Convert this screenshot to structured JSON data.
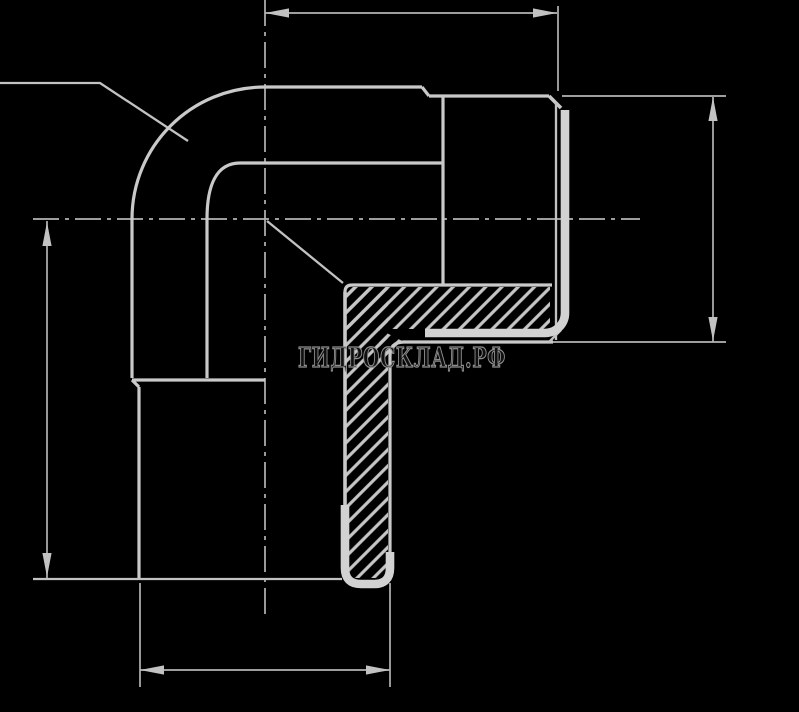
{
  "page": {
    "background": "#000000",
    "width": 799,
    "height": 712,
    "description_visible_content": "technical line drawing of a 90-degree elbow pipe fitting, half-section with hatching, four unlabelled dimension lines, dash-dot centerlines and a watermark"
  },
  "drawing": {
    "watermark": {
      "text": "ГИДРОСКЛАД.РФ",
      "x": 298,
      "y": 367,
      "font_size": 27,
      "text_length": 208,
      "fill": "#101010",
      "stroke": "#8e8e8e",
      "stroke_width": 1.25
    },
    "styles": {
      "center": {
        "w": 1.7,
        "color": "#b4b4b4",
        "dash": "26 6 4 6"
      },
      "thin": {
        "w": 1.7,
        "color": "#b4b4b4",
        "dash": ""
      },
      "med": {
        "w": 2.3,
        "color": "#c2c2c2",
        "dash": ""
      },
      "main": {
        "w": 3.2,
        "color": "#c9c9c9",
        "dash": ""
      },
      "bold": {
        "w": 3.6,
        "color": "#c9c9c9",
        "dash": ""
      },
      "thick": {
        "w": 8.6,
        "color": "#d2d2d2",
        "dash": ""
      }
    },
    "hatch": {
      "spacing": 11.5,
      "line_width": 3.2,
      "angle": -45,
      "color": "#c6c6c6"
    },
    "hatch_regions": [
      {
        "name": "hatch-horizontal-wall",
        "d": "M346,287 H550 V329 H346 Z"
      },
      {
        "name": "hatch-vertical-wall",
        "d": "M346,287 H388 V578 H346 Z"
      },
      {
        "name": "hatch-fillet-corner",
        "d": "M379,329 L404,342 L390,356 L379,350 Z"
      }
    ],
    "shapes": [
      {
        "name": "centerline-vertical",
        "kind": "center",
        "d": "M265,0 V614"
      },
      {
        "name": "centerline-horizontal",
        "kind": "center",
        "d": "M33,219 H640"
      },
      {
        "name": "dim-line-top",
        "kind": "thin",
        "d": "M265,13 H557"
      },
      {
        "name": "dim-line-right",
        "kind": "thin",
        "d": "M713,97 V342"
      },
      {
        "name": "dim-line-left",
        "kind": "thin",
        "d": "M47,221 V578"
      },
      {
        "name": "dim-line-bottom",
        "kind": "thin",
        "d": "M140,670 H390"
      },
      {
        "name": "extension-top-right",
        "kind": "thin",
        "d": "M558,6 V91"
      },
      {
        "name": "extension-right-upper",
        "kind": "thin",
        "d": "M562,96 H726"
      },
      {
        "name": "extension-right-lower",
        "kind": "thin",
        "d": "M548,342 H726"
      },
      {
        "name": "extension-bottom-left",
        "kind": "thin",
        "d": "M140,583 V687"
      },
      {
        "name": "extension-bottom-right",
        "kind": "thin",
        "d": "M390,583 V687"
      },
      {
        "name": "leader-upper-left",
        "kind": "med",
        "d": "M0,83 H100 L188,141"
      },
      {
        "name": "leader-inner-corner",
        "kind": "med",
        "d": "M267,221 L343,283"
      },
      {
        "name": "outer-bend-arc",
        "kind": "main",
        "d": "M132,219 C132,146 191,87 265,87"
      },
      {
        "name": "outer-top-line",
        "kind": "main",
        "d": "M265,87 H422"
      },
      {
        "name": "step-top",
        "kind": "main",
        "d": "M422,87 L429,96"
      },
      {
        "name": "nipple-top-line",
        "kind": "main",
        "d": "M429,96 H549"
      },
      {
        "name": "chamfer-top-right",
        "kind": "bold",
        "d": "M549,96 L561,108"
      },
      {
        "name": "inner-bend-arc",
        "kind": "main",
        "d": "M207,219 C207,186 216,163 240,163"
      },
      {
        "name": "inner-top-line",
        "kind": "main",
        "d": "M240,163 H443"
      },
      {
        "name": "collar-face-line",
        "kind": "main",
        "d": "M443,96 V284"
      },
      {
        "name": "tube-outer-left",
        "kind": "main",
        "d": "M132,219 V378"
      },
      {
        "name": "tube-inner-right",
        "kind": "main",
        "d": "M207,219 V378"
      },
      {
        "name": "socket-top-face",
        "kind": "main",
        "d": "M132,380 H265"
      },
      {
        "name": "step-left",
        "kind": "main",
        "d": "M132,380 L139,387"
      },
      {
        "name": "socket-outer-left",
        "kind": "main",
        "d": "M139,387 V579"
      },
      {
        "name": "bore-horizontal",
        "kind": "main",
        "d": "M352,285 H552"
      },
      {
        "name": "bore-corner-fillet",
        "kind": "main",
        "d": "M345,292 Q345,285 352,285"
      },
      {
        "name": "bore-vertical",
        "kind": "bold",
        "d": "M345,292 V560"
      },
      {
        "name": "outer-bottom-line",
        "kind": "main",
        "d": "M404,342 H553"
      },
      {
        "name": "inner-corner-fillet",
        "kind": "main",
        "d": "M404,342 Q390,342 390,356"
      },
      {
        "name": "socket-outer-right",
        "kind": "main",
        "d": "M390,356 V572"
      },
      {
        "name": "end-face-right-thin",
        "kind": "med",
        "d": "M556,102 V340"
      },
      {
        "name": "chamfer-bottom-right",
        "kind": "med",
        "d": "M549,342 L561,330"
      },
      {
        "name": "end-face-bottom-line",
        "kind": "med",
        "d": "M33,579 H342"
      },
      {
        "name": "thread-root-thick-bar",
        "kind": "thick",
        "d": "M425,333 H545 A20,20 0 0 0 565,313 V110"
      },
      {
        "name": "bottom-end-thick-u",
        "kind": "thick",
        "d": "M345,505 V568 Q345,584 361,584 H374 Q390,584 390,568 V552"
      }
    ],
    "arrows": [
      {
        "name": "arrow-dim-top-left",
        "x": 265,
        "y": 13,
        "dir": "left"
      },
      {
        "name": "arrow-dim-top-right",
        "x": 557,
        "y": 13,
        "dir": "right"
      },
      {
        "name": "arrow-dim-right-up",
        "x": 713,
        "y": 97,
        "dir": "up"
      },
      {
        "name": "arrow-dim-right-down",
        "x": 713,
        "y": 341,
        "dir": "down"
      },
      {
        "name": "arrow-dim-left-up",
        "x": 47,
        "y": 222,
        "dir": "up"
      },
      {
        "name": "arrow-dim-left-down",
        "x": 47,
        "y": 577,
        "dir": "down"
      },
      {
        "name": "arrow-dim-bottom-left",
        "x": 140,
        "y": 670,
        "dir": "left"
      },
      {
        "name": "arrow-dim-bottom-right",
        "x": 390,
        "y": 670,
        "dir": "right"
      }
    ],
    "arrow_geometry": {
      "length": 24,
      "half_width": 4.6,
      "color": "#c2c2c2"
    }
  }
}
